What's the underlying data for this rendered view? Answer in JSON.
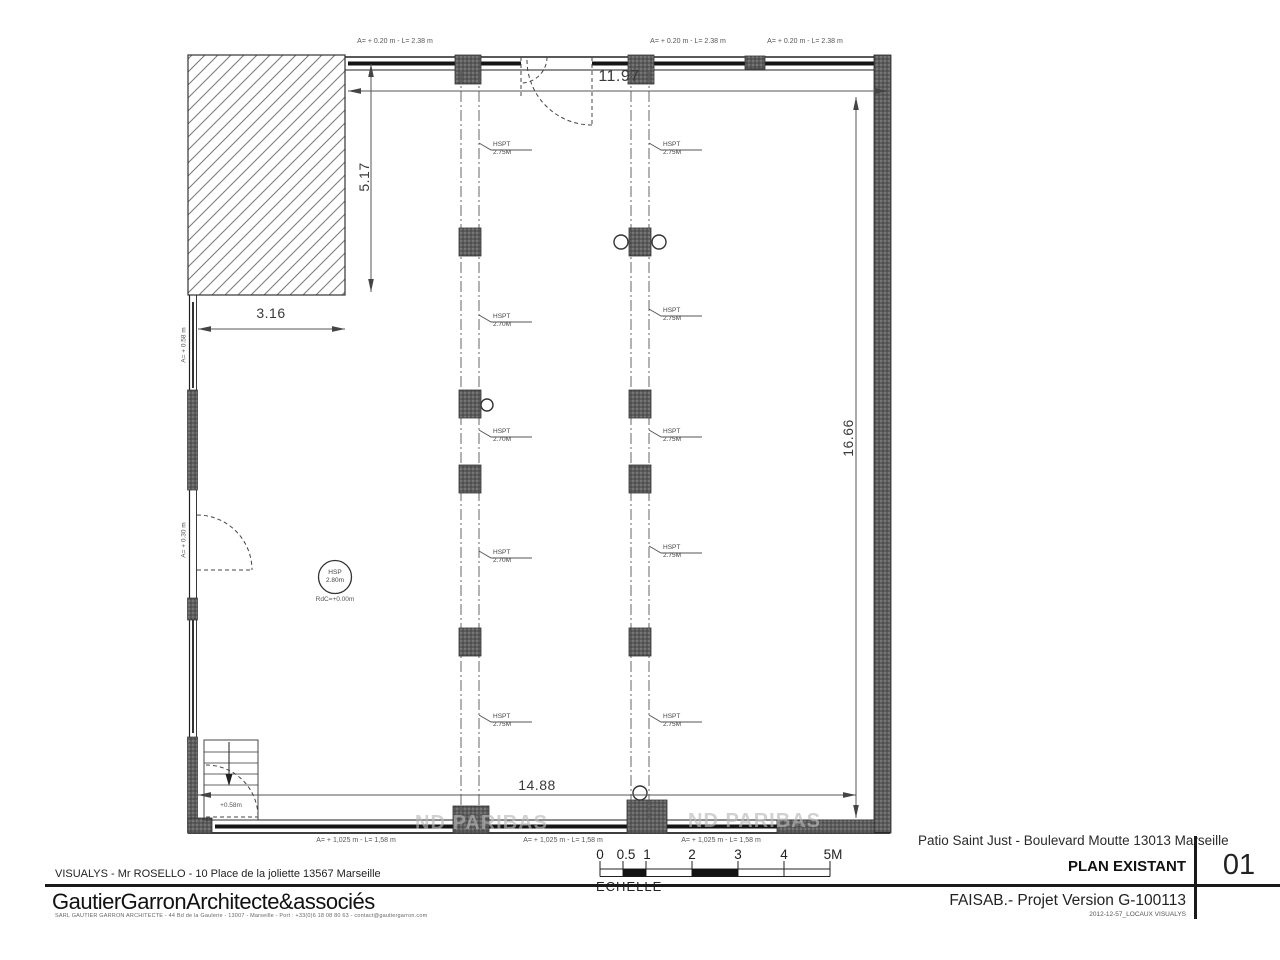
{
  "title_block": {
    "address": "Patio Saint Just - Boulevard Moutte 13013 Marseille",
    "drawing_title": "PLAN EXISTANT",
    "sheet_number": "01",
    "version_line": "FAISAB.- Projet Version G-100113",
    "file_ref": "2012-12-57_LOCAUX VISUALYS",
    "client": "VISUALYS - Mr ROSELLO - 10 Place de la joliette 13567 Marseille",
    "firm": "GautierGarronArchitecte&associés",
    "firm_details": "SARL GAUTIER GARRON ARCHITECTE - 44 Bd de la Gaulerie - 13007 - Marseille - Port : +33(0)6 18 08 80 63 - contact@gautiergarron.com"
  },
  "scale_bar": {
    "caption": "ECHELLE",
    "ticks": [
      "0",
      "0.5",
      "1",
      "2",
      "3",
      "4",
      "5M"
    ]
  },
  "dimensions": {
    "top_width": "11.97",
    "left_height": "5.17",
    "left_offset": "3.16",
    "right_height": "16.66",
    "bottom_width": "14.88"
  },
  "openings": {
    "top_windows": [
      "A= + 0.20 m - L= 2.38 m",
      "A= + 0.20 m - L= 2.38 m",
      "A= + 0.20 m - L= 2.38 m"
    ],
    "bottom_windows": [
      "A= + 1,025 m - L= 1,58 m",
      "A= + 1,025 m - L= 1,58 m",
      "A= + 1,025 m - L= 1,58 m"
    ],
    "left_wall": [
      "A= + 0.58 m",
      "A= + 0.30 m"
    ],
    "stair_door": "+0.58m"
  },
  "ceiling_heights": {
    "label": "HSPT",
    "left_column_line": [
      "2.75M",
      "2.70M",
      "2.70M",
      "2.70M",
      "2.75M"
    ],
    "right_column_line": [
      "2.75M",
      "2.75M",
      "2.75M",
      "2.75M",
      "2.75M"
    ]
  },
  "room_info": {
    "hsp_label": "HSP",
    "hsp_value": "2.80m",
    "floor_level": "RdC=+0.00m"
  },
  "watermark": "ND PARIBAS"
}
